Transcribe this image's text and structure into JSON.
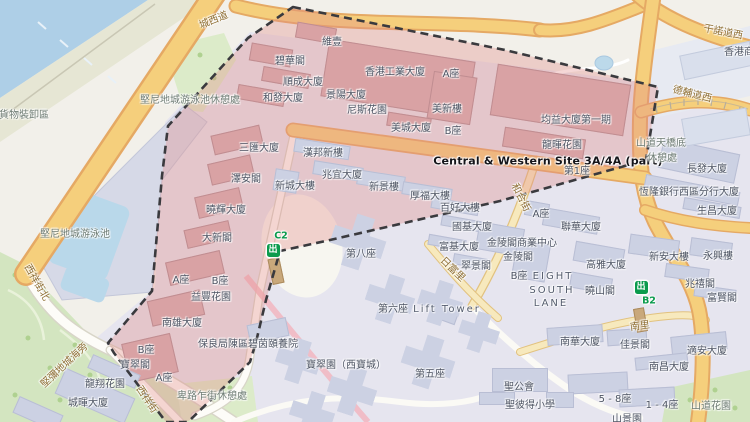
{
  "map": {
    "site_name": "Central & Western Site 3A/4A (part)",
    "exit_glyph": "出",
    "colors": {
      "water": "#aecfe7",
      "park": "#d3e5c0",
      "road_major": "#f5cf7c",
      "road_minor": "#f7e9bd",
      "site_overlay": "rgba(227,139,135,0.34)",
      "site_building": "#d9a2a4",
      "building": "#ccd1e3",
      "boundary_dash": "#3a3a3e",
      "mtr_green": "#0b9b4d",
      "road_label": "#8e6e33",
      "building_label": "#4c5362"
    },
    "exits": [
      {
        "code": "C2",
        "icon_x": 273,
        "icon_y": 250,
        "label_x": 281,
        "label_y": 236
      },
      {
        "code": "B2",
        "icon_x": 641,
        "icon_y": 287,
        "label_x": 649,
        "label_y": 301
      }
    ],
    "labels": [
      {
        "t": "城西道",
        "x": 214,
        "y": 21,
        "c": "road",
        "r": -22
      },
      {
        "t": "干諾道西",
        "x": 723,
        "y": 33,
        "c": "road",
        "r": 11
      },
      {
        "t": "香港商",
        "x": 739,
        "y": 53,
        "c": "bldg"
      },
      {
        "t": "德輔道西",
        "x": 692,
        "y": 95,
        "c": "road",
        "r": 14
      },
      {
        "t": "貨物裝卸區",
        "x": 24,
        "y": 116,
        "c": "area"
      },
      {
        "t": "堅尼地城游泳池休憩處",
        "x": 190,
        "y": 101,
        "c": "area"
      },
      {
        "t": "堅尼地城游泳池",
        "x": 75,
        "y": 235,
        "c": "area"
      },
      {
        "t": "西祥街北",
        "x": 36,
        "y": 283,
        "c": "road",
        "r": 60
      },
      {
        "t": "堅彌地城海旁",
        "x": 65,
        "y": 366,
        "c": "road",
        "r": -43
      },
      {
        "t": "西祥街",
        "x": 146,
        "y": 400,
        "c": "road",
        "r": 56
      },
      {
        "t": "龍翔花園",
        "x": 105,
        "y": 385,
        "c": "bldg"
      },
      {
        "t": "城暉大廈",
        "x": 88,
        "y": 404,
        "c": "bldg"
      },
      {
        "t": "卑路乍街休憩處",
        "x": 212,
        "y": 397,
        "c": "area"
      },
      {
        "t": "維壹",
        "x": 332,
        "y": 43,
        "c": "bldg"
      },
      {
        "t": "碧華閣",
        "x": 290,
        "y": 62,
        "c": "bldg"
      },
      {
        "t": "順成大廈",
        "x": 303,
        "y": 83,
        "c": "bldg"
      },
      {
        "t": "和發大廈",
        "x": 283,
        "y": 99,
        "c": "bldg"
      },
      {
        "t": "香港工業大廈",
        "x": 395,
        "y": 73,
        "c": "bldg"
      },
      {
        "t": "A座",
        "x": 451,
        "y": 75,
        "c": "bldg"
      },
      {
        "t": "景陽大廈",
        "x": 346,
        "y": 96,
        "c": "bldg"
      },
      {
        "t": "尼斯花園",
        "x": 367,
        "y": 111,
        "c": "bldg"
      },
      {
        "t": "美新樓",
        "x": 447,
        "y": 110,
        "c": "bldg"
      },
      {
        "t": "美城大廈",
        "x": 411,
        "y": 129,
        "c": "bldg"
      },
      {
        "t": "B座",
        "x": 453,
        "y": 132,
        "c": "bldg"
      },
      {
        "t": "均益大廈第一期",
        "x": 576,
        "y": 121,
        "c": "bldg"
      },
      {
        "t": "龍暉花園",
        "x": 562,
        "y": 146,
        "c": "bldg"
      },
      {
        "t": "Central & Western Site 3A/4A (part)",
        "x": 548,
        "y": 161,
        "c": "site"
      },
      {
        "t": "第1座",
        "x": 577,
        "y": 172,
        "c": "bldg"
      },
      {
        "t": "三匯大廈",
        "x": 259,
        "y": 149,
        "c": "bldg"
      },
      {
        "t": "澤安閣",
        "x": 246,
        "y": 180,
        "c": "bldg"
      },
      {
        "t": "曉輝大廈",
        "x": 226,
        "y": 211,
        "c": "bldg"
      },
      {
        "t": "大新閣",
        "x": 217,
        "y": 239,
        "c": "bldg"
      },
      {
        "t": "A座",
        "x": 181,
        "y": 281,
        "c": "bldg"
      },
      {
        "t": "B座",
        "x": 220,
        "y": 282,
        "c": "bldg"
      },
      {
        "t": "益豐花園",
        "x": 211,
        "y": 298,
        "c": "bldg"
      },
      {
        "t": "南雄大廈",
        "x": 182,
        "y": 324,
        "c": "bldg"
      },
      {
        "t": "B座",
        "x": 146,
        "y": 351,
        "c": "bldg"
      },
      {
        "t": "寶翠閣",
        "x": 135,
        "y": 366,
        "c": "bldg"
      },
      {
        "t": "A座",
        "x": 164,
        "y": 379,
        "c": "bldg"
      },
      {
        "t": "山道天橋底",
        "x": 661,
        "y": 144,
        "c": "area"
      },
      {
        "t": "休憩處",
        "x": 662,
        "y": 159,
        "c": "area"
      },
      {
        "t": "長發大廈",
        "x": 707,
        "y": 170,
        "c": "bldg"
      },
      {
        "t": "恆隆銀行西區分行大廈",
        "x": 689,
        "y": 193,
        "c": "bldg"
      },
      {
        "t": "生昌大廈",
        "x": 717,
        "y": 212,
        "c": "bldg"
      },
      {
        "t": "和合街",
        "x": 520,
        "y": 198,
        "c": "road",
        "r": 63
      },
      {
        "t": "新安大樓",
        "x": 669,
        "y": 258,
        "c": "bldg"
      },
      {
        "t": "永興樓",
        "x": 718,
        "y": 257,
        "c": "bldg"
      },
      {
        "t": "兆禧閣",
        "x": 700,
        "y": 285,
        "c": "bldg"
      },
      {
        "t": "富賢閣",
        "x": 722,
        "y": 299,
        "c": "bldg"
      },
      {
        "t": "南里",
        "x": 640,
        "y": 327,
        "c": "road",
        "r": -8
      },
      {
        "t": "適安大廈",
        "x": 707,
        "y": 352,
        "c": "bldg"
      },
      {
        "t": "南昌大廈",
        "x": 669,
        "y": 368,
        "c": "bldg"
      },
      {
        "t": "山道花園",
        "x": 711,
        "y": 407,
        "c": "area"
      },
      {
        "t": "1 - 4座",
        "x": 662,
        "y": 406,
        "c": "bldg"
      },
      {
        "t": "5 - 8座",
        "x": 615,
        "y": 400,
        "c": "bldg"
      },
      {
        "t": "聖公會",
        "x": 519,
        "y": 388,
        "c": "bldg"
      },
      {
        "t": "聖彼得小學",
        "x": 530,
        "y": 406,
        "c": "bldg"
      },
      {
        "t": "山景園",
        "x": 627,
        "y": 420,
        "c": "bldg"
      },
      {
        "t": "南華大廈",
        "x": 580,
        "y": 343,
        "c": "bldg"
      },
      {
        "t": "佳景閣",
        "x": 635,
        "y": 346,
        "c": "bldg"
      },
      {
        "t": "曉山閣",
        "x": 600,
        "y": 292,
        "c": "bldg"
      },
      {
        "t": "高雅大廈",
        "x": 606,
        "y": 266,
        "c": "bldg"
      },
      {
        "t": "EIGHT",
        "x": 553,
        "y": 277,
        "c": "en"
      },
      {
        "t": "SOUTH",
        "x": 552,
        "y": 291,
        "c": "en"
      },
      {
        "t": "LANE",
        "x": 551,
        "y": 304,
        "c": "en"
      },
      {
        "t": "B座",
        "x": 519,
        "y": 277,
        "c": "bldg"
      },
      {
        "t": "金陵閣",
        "x": 518,
        "y": 258,
        "c": "bldg"
      },
      {
        "t": "金陵閣商業中心",
        "x": 522,
        "y": 244,
        "c": "bldg"
      },
      {
        "t": "翠景閣",
        "x": 476,
        "y": 267,
        "c": "bldg"
      },
      {
        "t": "富基大廈",
        "x": 459,
        "y": 248,
        "c": "bldg"
      },
      {
        "t": "國基大廈",
        "x": 472,
        "y": 228,
        "c": "bldg"
      },
      {
        "t": "百好大樓",
        "x": 460,
        "y": 209,
        "c": "bldg"
      },
      {
        "t": "厚福大樓",
        "x": 430,
        "y": 197,
        "c": "bldg"
      },
      {
        "t": "A座",
        "x": 541,
        "y": 215,
        "c": "bldg"
      },
      {
        "t": "聯華大廈",
        "x": 581,
        "y": 228,
        "c": "bldg"
      },
      {
        "t": "日富里",
        "x": 452,
        "y": 270,
        "c": "road",
        "r": 44
      },
      {
        "t": "新景樓",
        "x": 384,
        "y": 188,
        "c": "bldg"
      },
      {
        "t": "兆宜大廈",
        "x": 342,
        "y": 176,
        "c": "bldg"
      },
      {
        "t": "新城大樓",
        "x": 295,
        "y": 187,
        "c": "bldg"
      },
      {
        "t": "漢邦新樓",
        "x": 323,
        "y": 154,
        "c": "bldg"
      },
      {
        "t": "第八座",
        "x": 361,
        "y": 255,
        "c": "bldg"
      },
      {
        "t": "第六座",
        "x": 393,
        "y": 310,
        "c": "bldg"
      },
      {
        "t": "Lift Tower",
        "x": 447,
        "y": 310,
        "c": "en"
      },
      {
        "t": "寶翠園（西寶城）",
        "x": 346,
        "y": 366,
        "c": "bldg"
      },
      {
        "t": "第五座",
        "x": 430,
        "y": 375,
        "c": "bldg"
      },
      {
        "t": "保良局陳區碧茵頤養院",
        "x": 248,
        "y": 345,
        "c": "bldg"
      }
    ]
  }
}
